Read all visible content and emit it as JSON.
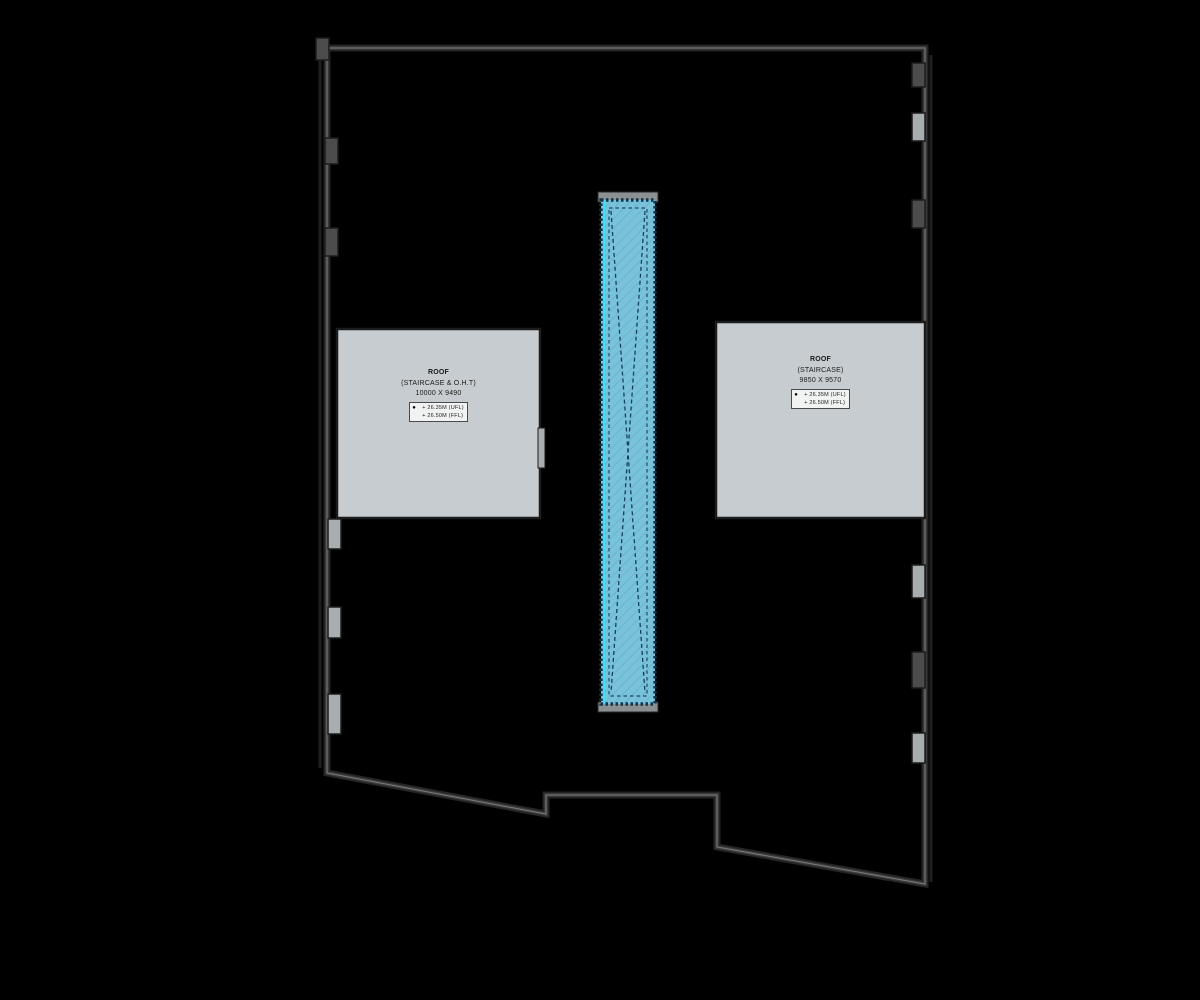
{
  "drawing": {
    "type": "roof-plan",
    "colors": {
      "background": "#000000",
      "wall_stroke": "#3a3a3a",
      "wall_highlight": "#6e6e6e",
      "tab_fill": "#a8adb0",
      "roof_fill": "#c6cccf",
      "roof_border": "#1c1c1c",
      "strip_fill": "#79c2da",
      "strip_hatch": "#5fb0cc",
      "strip_border": "#10354f",
      "strip_edge_cyan": "#3ae0f6",
      "cap_fill": "#8b9093",
      "text": "#1b1b1b"
    }
  },
  "left_roof": {
    "title": "ROOF",
    "subtitle": "(STAIRCASE & O.H.T)",
    "dimensions": "10000 X 9490",
    "level_marker": "●",
    "levels": {
      "0": "+ 26.35M (UFL)",
      "1": "+ 26.50M (FFL)"
    }
  },
  "right_roof": {
    "title": "ROOF",
    "subtitle": "(STAIRCASE)",
    "dimensions": "9850 X 9570",
    "level_marker": "●",
    "levels": {
      "0": "+ 26.35M (UFL)",
      "1": "+ 26.50M (FFL)"
    }
  }
}
